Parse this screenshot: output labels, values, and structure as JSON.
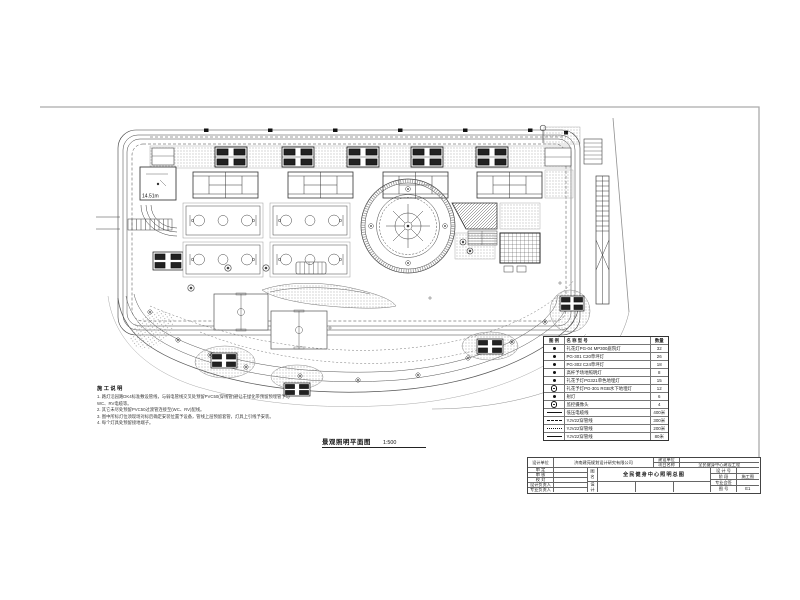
{
  "page": {
    "background": "#ffffff",
    "line_color": "#3a3a3a",
    "sheet_border_color": "#aaaaaa"
  },
  "drawing_title": {
    "text": "景观照明平面图",
    "scale": "1:500"
  },
  "plan": {
    "building_height_label": "14.51m"
  },
  "notes": {
    "title": "施工说明",
    "lines": [
      "1. 路灯沿园路DK4标准敷设管线，与弱电管线交叉处预留PVC50(穿线管)避让于绿化带预留预埋管予与",
      "WC、RV电缆等。",
      "2. 其它未尽处预留PVC50过渡管连接至(WC、RV)配线。",
      "3. 图中所标灯位须现场对标后确定安装位置予设备，管线上层预留套管，灯具上引线予安装。",
      "4. 每个灯具处预留接地端子。"
    ]
  },
  "legend": {
    "headers": {
      "symbol": "图  例",
      "name": "名  称  型  号",
      "qty": "数量"
    },
    "rows": [
      {
        "name": "礼花灯PG-04 MP300庭院灯",
        "qty": "32"
      },
      {
        "name": "PG-301 C20草坪灯",
        "qty": "26"
      },
      {
        "name": "PG-302 C24草坪灯",
        "qty": "18"
      },
      {
        "name": "高杆予场地照明灯",
        "qty": "8"
      },
      {
        "name": "礼花予灯PG321单色地埋灯",
        "qty": "15"
      },
      {
        "name": "礼花予灯PG-301 RGB水下地埋灯",
        "qty": "12"
      },
      {
        "name": "射灯",
        "qty": "6"
      },
      {
        "name": "监控摄像头",
        "qty": "4"
      },
      {
        "name": "低压电缆线",
        "qty": "400米"
      },
      {
        "name": "YJV22穿管线",
        "qty": "300米"
      },
      {
        "name": "YJV22穿管线",
        "qty": "200米"
      },
      {
        "name": "YJV22穿管线",
        "qty": "80米"
      }
    ]
  },
  "title_block": {
    "design_unit_label": "设计单位",
    "design_unit": "济南建苑规划设计研究有限公司",
    "client_label": "建设单位",
    "client": "",
    "project_label": "项目名称",
    "project": "全民健身中心建设工程",
    "rows_left": [
      "审  定",
      "审  核",
      "校  对",
      "设计负责人",
      "专业负责人"
    ],
    "name_col_top": "图名",
    "name_col_bottom": "设计",
    "drawing_name": "全民健身中心照明总图",
    "right_rows": [
      {
        "label": "设 计 号",
        "value": ""
      },
      {
        "label": "阶  段",
        "value": "施工图"
      },
      {
        "label": "专业会签",
        "value": ""
      },
      {
        "label": "图  号",
        "value": "E1"
      }
    ]
  }
}
